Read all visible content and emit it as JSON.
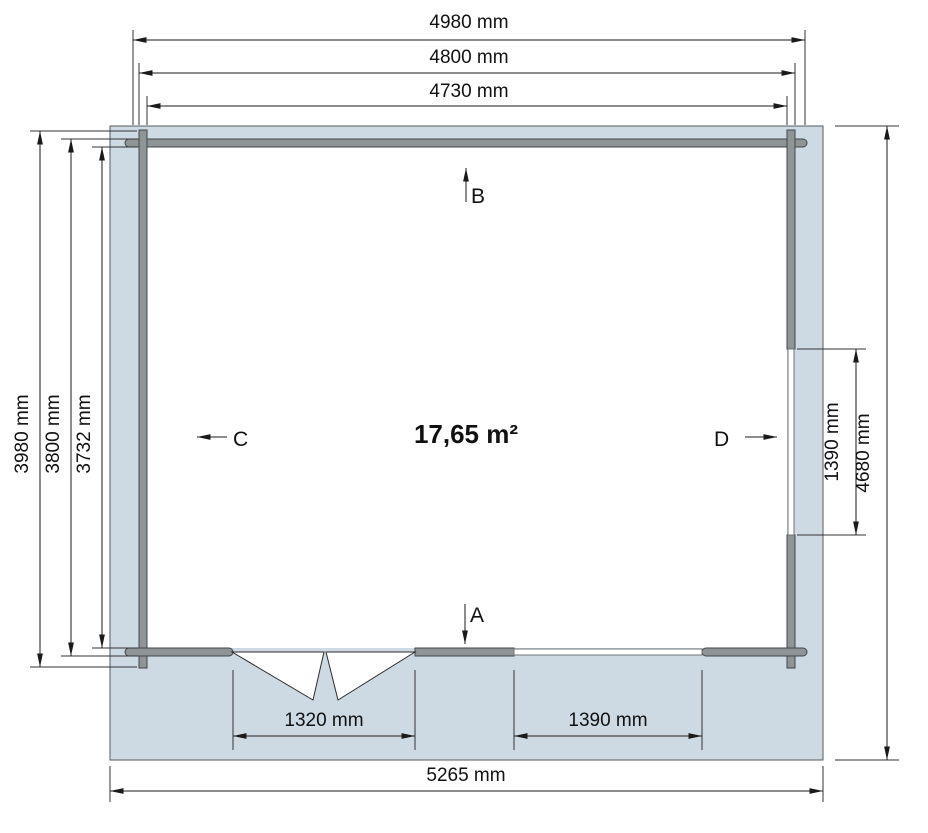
{
  "plan": {
    "area_label": "17,65 m²",
    "side_markers": {
      "front": "A",
      "back": "B",
      "left": "C",
      "right": "D"
    },
    "dimensions": {
      "top_outer": "4980 mm",
      "top_mid": "4800 mm",
      "top_inner": "4730 mm",
      "left_outer": "3980 mm",
      "left_mid": "3800 mm",
      "left_inner": "3732 mm",
      "right_window": "1390 mm",
      "right_overall": "4680 mm",
      "door_width": "1320 mm",
      "bottom_window": "1390 mm",
      "bottom_overall": "5265 mm"
    },
    "colors": {
      "foundation": "#cdd9e3",
      "interior": "#ffffff",
      "wall_fill": "#8f9496",
      "window_fill": "#ffffff",
      "door_fill": "#ffffff",
      "line": "#1a1a1a"
    }
  }
}
